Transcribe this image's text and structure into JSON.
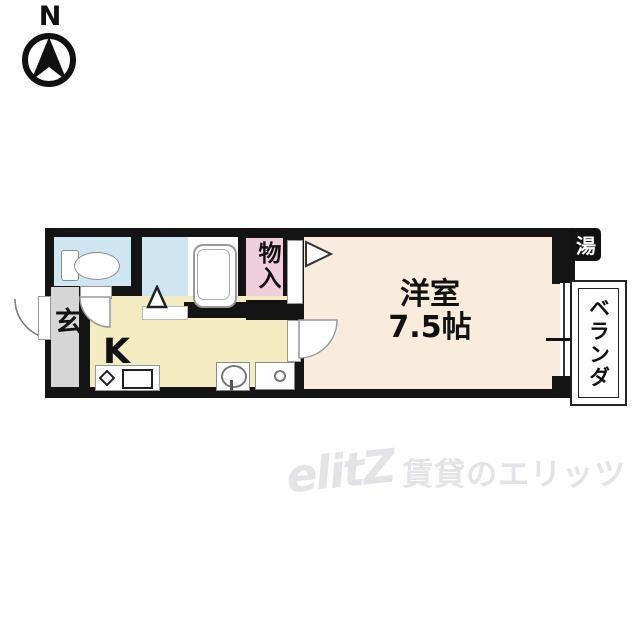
{
  "compass": {
    "label": "N"
  },
  "floorplan": {
    "rooms": {
      "entrance": {
        "label": "玄"
      },
      "kitchen": {
        "label": "K"
      },
      "closet": {
        "label": "物入"
      },
      "western_room": {
        "label": "洋室",
        "size": "7.5帖"
      },
      "veranda": {
        "label": "ベランダ"
      },
      "water_heater": {
        "label": "湯"
      }
    },
    "colors": {
      "wall": "#141414",
      "entrance_floor": "#d6d6d6",
      "kitchen_floor": "#f3ebc2",
      "western_room_floor": "#f9ecdc",
      "wet_area_floor": "#cfe5f2",
      "closet_floor": "#f0cedb",
      "fixture_outline": "#8a8a8a"
    }
  },
  "watermark": {
    "logo": "elitZ",
    "text": "賃貸のエリッツ",
    "color": "#e4e4e8"
  }
}
